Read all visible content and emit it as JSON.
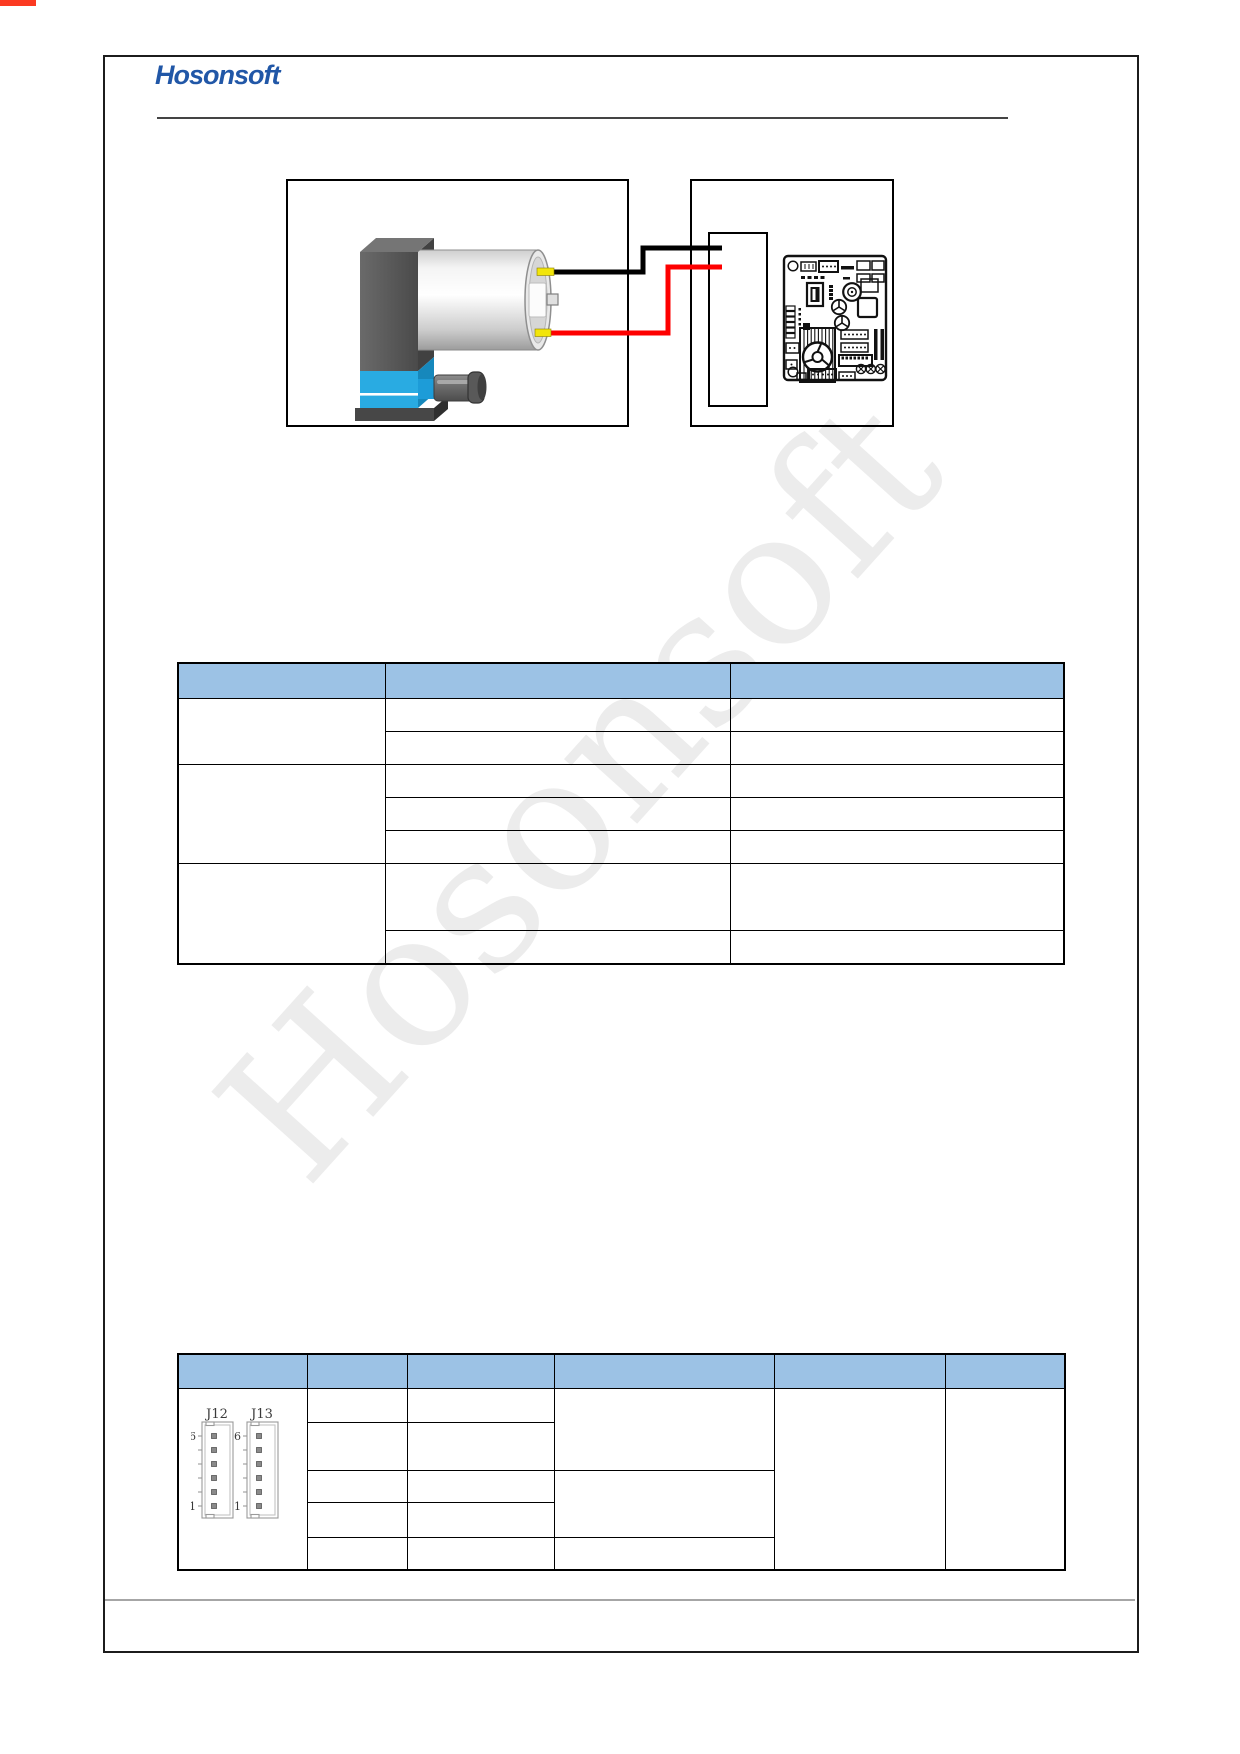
{
  "page": {
    "corner_mark_color": "#fb3a21"
  },
  "header": {
    "logo_text": "Hosonsoft",
    "logo_color": "#2157A7"
  },
  "watermark": {
    "text": "Hosonsoft"
  },
  "figure": {
    "left_box_content": "pump-product-photo",
    "right_box_content": "driver-board-with-connector-outline",
    "wire_negative_color": "#000000",
    "wire_positive_color": "#FE0000",
    "terminal_color": "#F2E50A",
    "pump_blue": "#29ABE2"
  },
  "upper_table": {
    "header_fill": "#9CC2E5",
    "columns": [
      "",
      "",
      ""
    ],
    "body_rows": 7
  },
  "lower_table": {
    "header_fill": "#9CC2E5",
    "columns": [
      "",
      "",
      "",
      "",
      "",
      ""
    ],
    "body_rows": 5,
    "connectors": {
      "j12": {
        "label": "J12",
        "top_pin": "6",
        "bottom_pin": "1"
      },
      "j13": {
        "label": "J13",
        "top_pin": "6",
        "bottom_pin": "1"
      }
    }
  }
}
